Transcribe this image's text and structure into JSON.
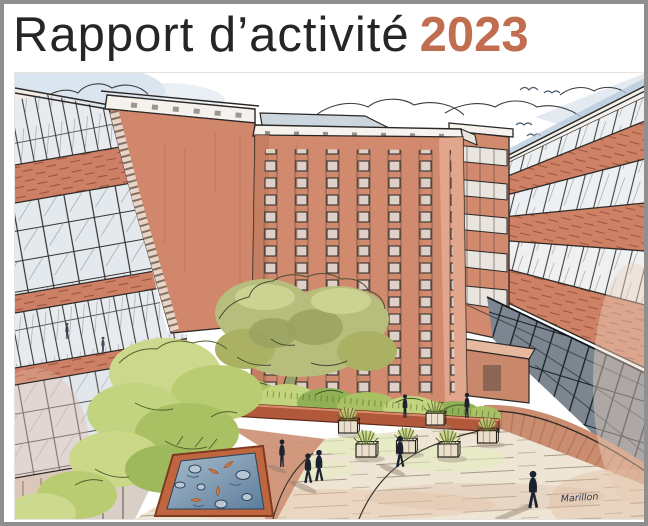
{
  "cover": {
    "title": "Rapport d’activité",
    "year": "2023",
    "signature": "Marillon"
  },
  "illustration": {
    "alt": "Hand-drawn illustration of a courtyard garden enclosed by terracotta hospital buildings, with a tall central tower, a large tree, green shrubs, a koi pond, planter boxes and people walking on a paved plaza"
  },
  "colors": {
    "accent": "#C06E4F",
    "title_text": "#262626",
    "page_border": "#8F8F8F",
    "facade_terracotta": "#D28A6F",
    "brick_line": "#8D4A33",
    "foliage_green": "#AEC272",
    "foliage_light": "#CCD98D",
    "pond_blue": "#6E8FA9",
    "koi_orange": "#D0763A",
    "paving_cream": "#EFE5D5",
    "walkway_terracotta": "#CA8D70",
    "sky_wash": "#CFDCE9",
    "ink": "#2E2A28",
    "people_silhouette": "#1C2330"
  }
}
